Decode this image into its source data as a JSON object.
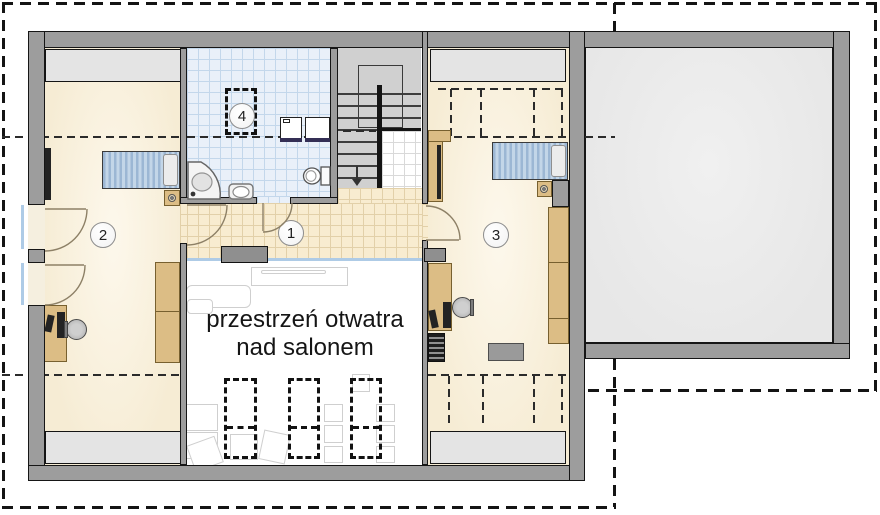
{
  "plan": {
    "type": "attic floor plan",
    "rooms": {
      "hall": {
        "number": "1"
      },
      "bedroom_left": {
        "number": "2"
      },
      "bedroom_right": {
        "number": "3"
      },
      "bathroom": {
        "number": "4"
      }
    },
    "open_space": {
      "line1": "przestrzeń otwatra",
      "line2": "nad salonem"
    },
    "colors": {
      "wall_gray": "#9d9d9d",
      "room_floor_beige": "#f6ecd4",
      "hall_tile_beige": "#f8ecd0",
      "bath_tile_blue": "#e9f0f9",
      "low_zone_gray": "#e4e4e4",
      "stair_gray": "#d0d0d0",
      "attic_void_gray": "#ececec",
      "furniture_tan": "#dcbd85",
      "bed_blue": "#a9c2db",
      "railing_blue": "#aecbe6",
      "washer_base_navy": "#342f55",
      "roof_line_black": "#141414"
    }
  }
}
